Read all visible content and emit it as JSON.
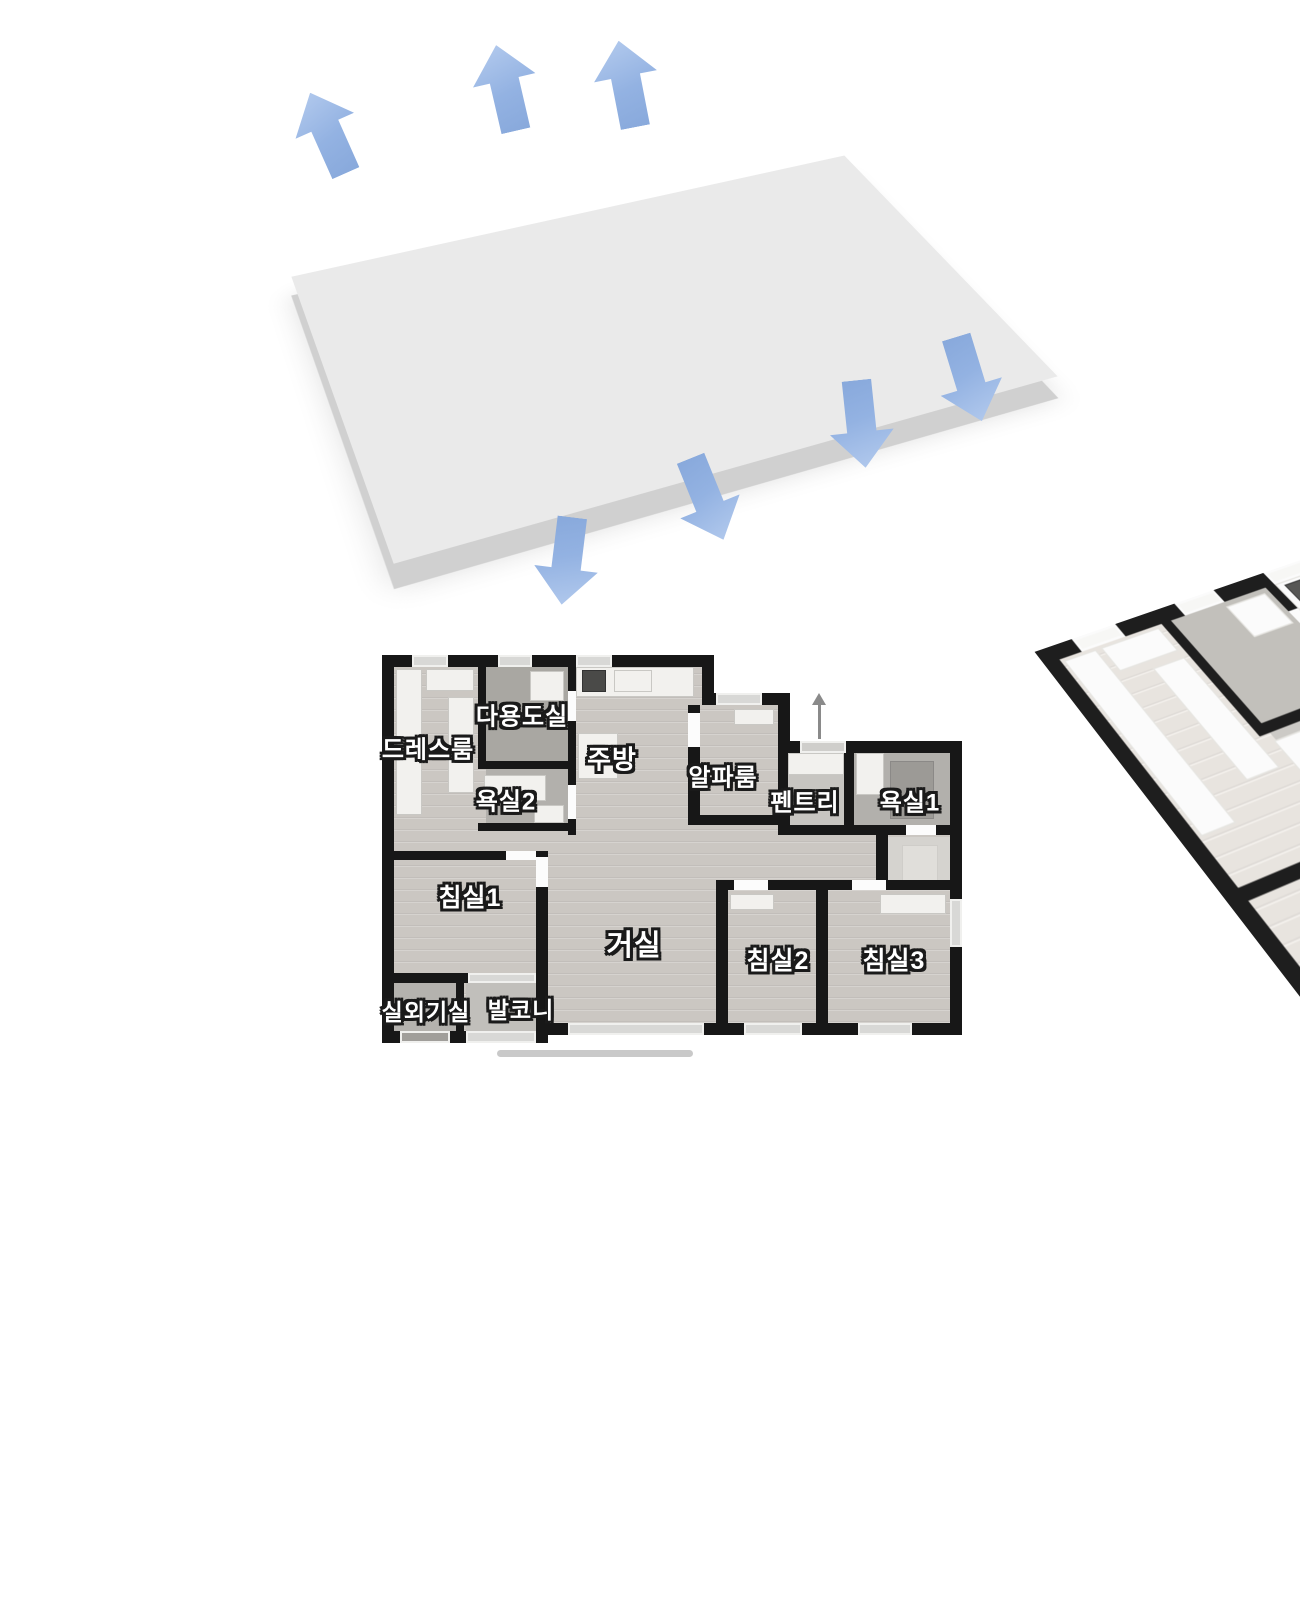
{
  "colors": {
    "wall": "#171717",
    "wood_floor": "#cbc7c2",
    "tile_floor": "#b2b0ac",
    "airflow_arrow": "#93b2e2",
    "slab_side": "#d0d0d0",
    "label_text": "#ffffff",
    "label_outline": "#1a1a1a"
  },
  "iso_view": {
    "airflow_arrows": [
      {
        "dir": "up",
        "cx": 328,
        "cy": 133,
        "rotate": -24
      },
      {
        "dir": "up",
        "cx": 506,
        "cy": 88,
        "rotate": -13
      },
      {
        "dir": "up",
        "cx": 627,
        "cy": 84,
        "rotate": -11
      },
      {
        "dir": "down",
        "cx": 861,
        "cy": 424,
        "rotate": 174
      },
      {
        "dir": "down",
        "cx": 969,
        "cy": 379,
        "rotate": 163
      },
      {
        "dir": "down",
        "cx": 707,
        "cy": 499,
        "rotate": 158
      },
      {
        "dir": "down",
        "cx": 567,
        "cy": 561,
        "rotate": 187
      }
    ]
  },
  "floor_plan": {
    "rooms": [
      {
        "id": "dressroom",
        "label": "드레스룸",
        "x": 46,
        "y": 92,
        "fs": 24
      },
      {
        "id": "utility",
        "label": "다용도실",
        "x": 140,
        "y": 59,
        "fs": 24
      },
      {
        "id": "kitchen",
        "label": "주방",
        "x": 230,
        "y": 103,
        "fs": 26
      },
      {
        "id": "bath2",
        "label": "욕실2",
        "x": 124,
        "y": 144,
        "fs": 24
      },
      {
        "id": "alpha",
        "label": "알파룸",
        "x": 341,
        "y": 120,
        "fs": 24
      },
      {
        "id": "pantry",
        "label": "펜트리",
        "x": 423,
        "y": 145,
        "fs": 24
      },
      {
        "id": "bath1",
        "label": "욕실1",
        "x": 528,
        "y": 145,
        "fs": 24
      },
      {
        "id": "bedroom1",
        "label": "침실1",
        "x": 88,
        "y": 241,
        "fs": 25
      },
      {
        "id": "living",
        "label": "거실",
        "x": 252,
        "y": 288,
        "fs": 29
      },
      {
        "id": "bedroom2",
        "label": "침실2",
        "x": 396,
        "y": 304,
        "fs": 25
      },
      {
        "id": "bedroom3",
        "label": "침실3",
        "x": 512,
        "y": 304,
        "fs": 25
      },
      {
        "id": "acroom",
        "label": "실외기실",
        "x": 44,
        "y": 355,
        "fs": 23
      },
      {
        "id": "balcony",
        "label": "발코니",
        "x": 139,
        "y": 353,
        "fs": 23
      }
    ]
  }
}
